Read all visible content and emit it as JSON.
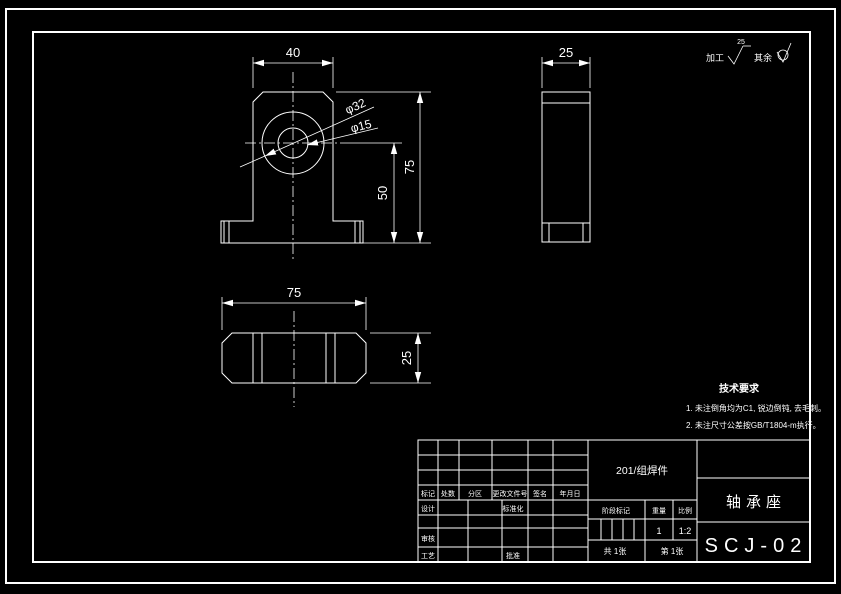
{
  "surface_note": {
    "machined_label": "加工",
    "roughness_value": "25",
    "others_label": "其余"
  },
  "views": {
    "front": {
      "dim_width": "40",
      "dim_height": "75",
      "dim_center_height": "50",
      "dim_outer_dia": "φ32",
      "dim_bore_dia": "φ15"
    },
    "side": {
      "dim_width": "25"
    },
    "top": {
      "dim_length": "75",
      "dim_depth": "25"
    }
  },
  "tech_requirements": {
    "title": "技术要求",
    "items": [
      "1.  未注倒角均为C1, 锐边倒钝, 去毛刺。",
      "2.  未注尺寸公差按GB/T1804-m执行。"
    ]
  },
  "title_block": {
    "material": "201/组焊件",
    "part_name": "轴承座",
    "drawing_no": "SCJ-02",
    "revision_labels": {
      "mark": "标记",
      "count": "处数",
      "zone": "分区",
      "change_file": "更改文件号",
      "signature": "签名",
      "date": "年月日"
    },
    "role_labels": {
      "design": "设计",
      "standardize": "标准化",
      "check": "审核",
      "process": "工艺",
      "approve": "批准"
    },
    "info_labels": {
      "stage_mark": "阶段标记",
      "weight": "重量",
      "scale": "比例"
    },
    "weight_value": "1",
    "scale_value": "1:2",
    "sheet_total": "共 1张",
    "sheet_no": "第 1张"
  }
}
